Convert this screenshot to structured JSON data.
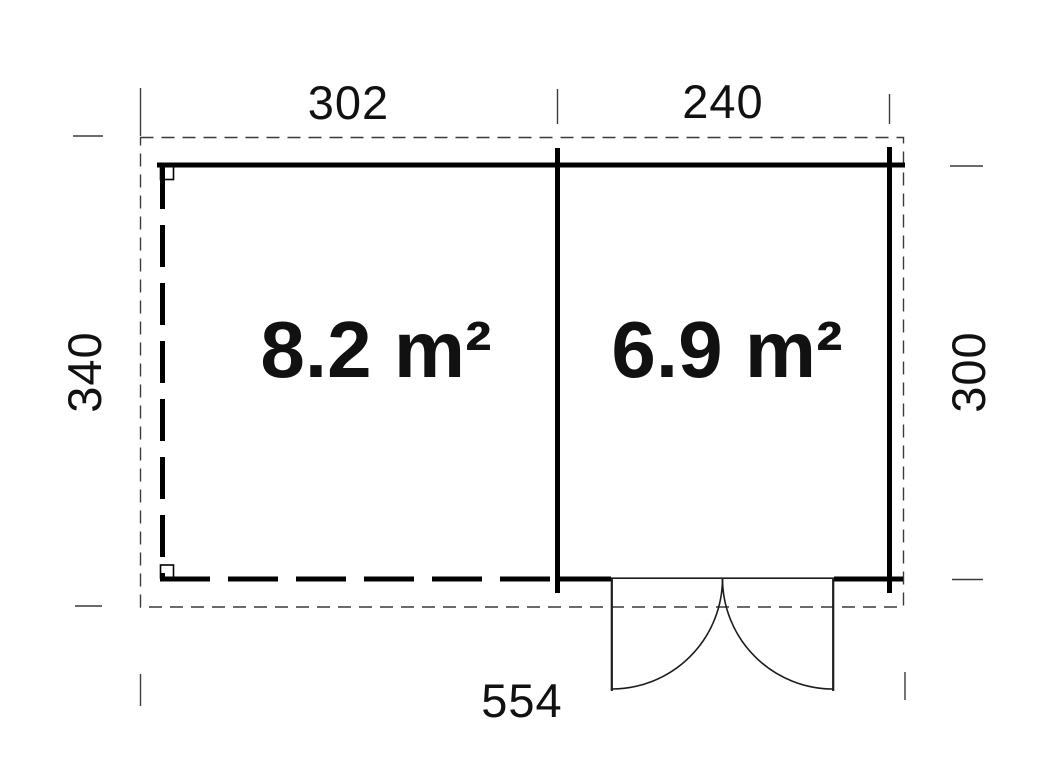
{
  "floor_plan": {
    "rooms": [
      {
        "name": "room-left",
        "area_label": "8.2 m²"
      },
      {
        "name": "room-right",
        "area_label": "6.9 m²"
      }
    ],
    "dimensions": {
      "top_left": "302",
      "top_right": "240",
      "left": "340",
      "right": "300",
      "bottom": "554"
    }
  },
  "colors": {
    "wall": "#000000",
    "thin_line": "#3a3a3a",
    "text": "#111111",
    "background": "#ffffff"
  }
}
